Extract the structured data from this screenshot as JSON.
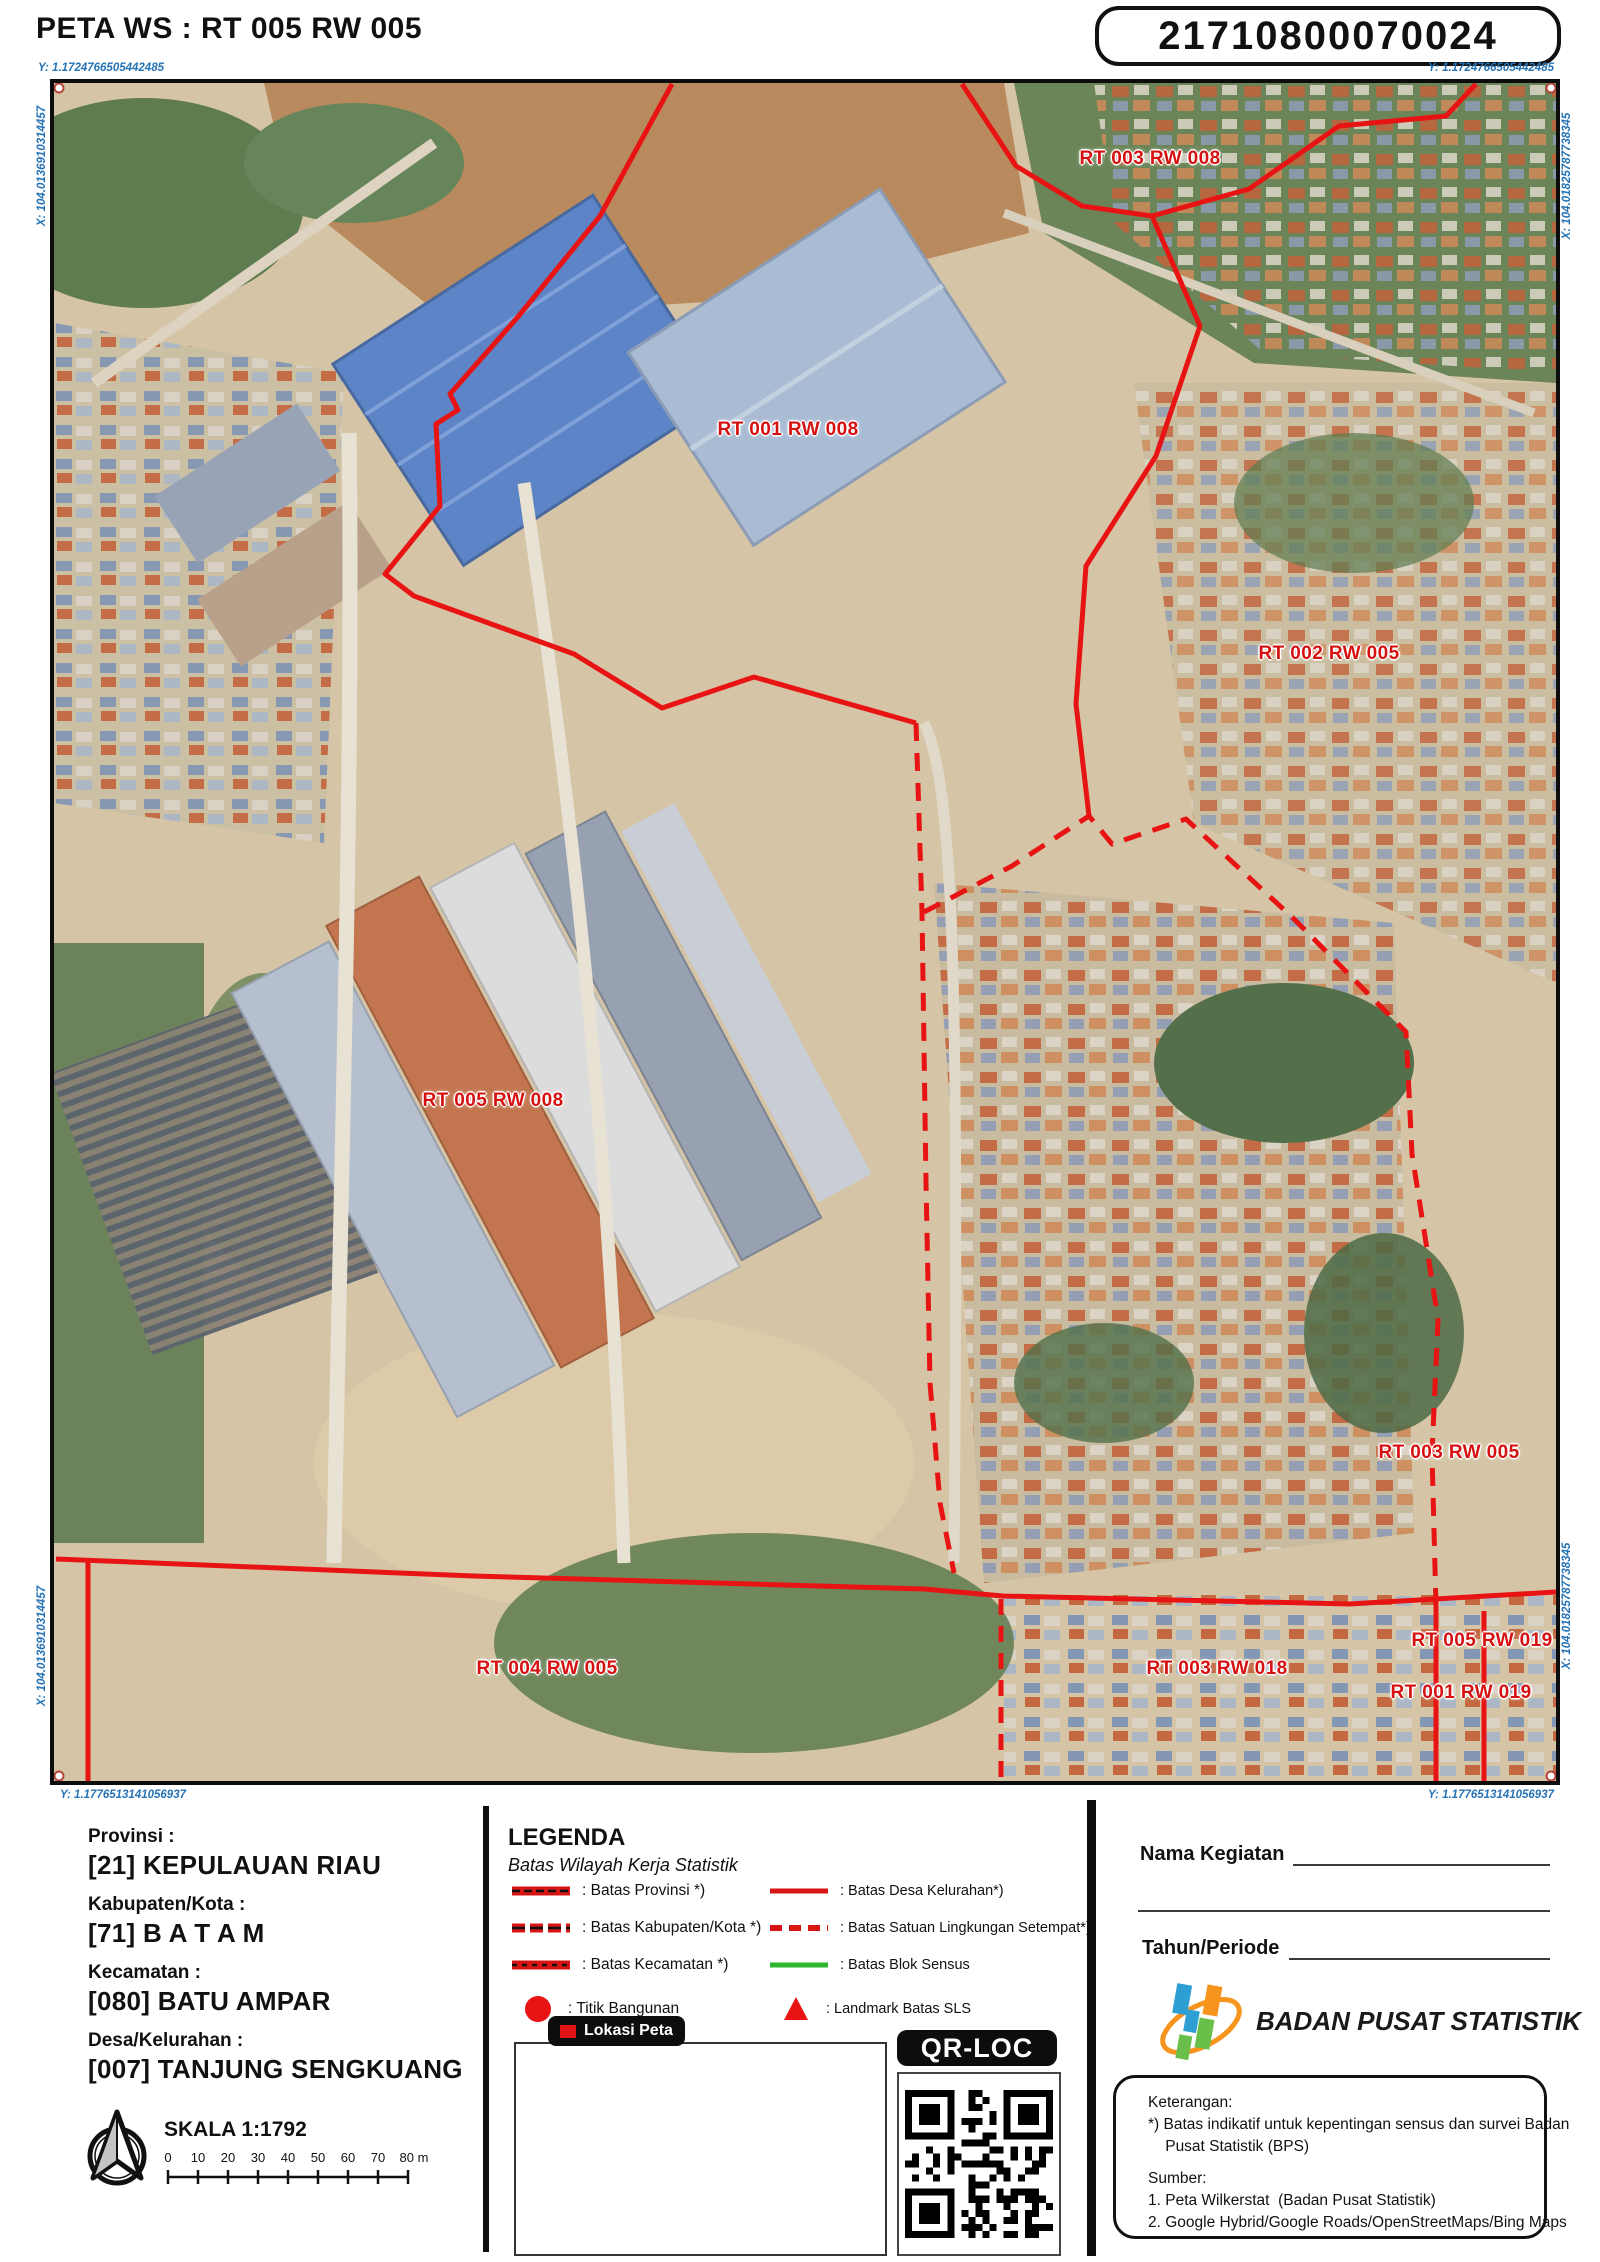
{
  "header": {
    "title": "PETA WS :  RT 005 RW 005",
    "id_box": "21710800070024"
  },
  "map": {
    "coords": {
      "top_left_y": "Y: 1.1724766505442485",
      "top_right_y": "Y: 1.1724766505442485",
      "bottom_left_y": "Y: 1.1776513141056937",
      "bottom_right_y": "Y: 1.1776513141056937",
      "left_x": "X: 104.0136910314457",
      "right_x": "X: 104.01825787738345"
    },
    "labels": [
      {
        "text": "RT 003 RW 008"
      },
      {
        "text": "RT 001 RW 008"
      },
      {
        "text": "RT 002 RW 005"
      },
      {
        "text": "RT 005 RW 008"
      },
      {
        "text": "RT 003 RW 005"
      },
      {
        "text": "RT 004 RW 005"
      },
      {
        "text": "RT 003 RW 018"
      },
      {
        "text": "RT 005 RW 019"
      },
      {
        "text": "RT 001 RW 019"
      }
    ],
    "boundary_color": "#e81414",
    "label_color": "#d61111"
  },
  "info": {
    "rows": [
      {
        "label": "Provinsi :",
        "value": "[21] KEPULAUAN RIAU"
      },
      {
        "label": "Kabupaten/Kota :",
        "value": "[71] B A T A M"
      },
      {
        "label": "Kecamatan :",
        "value": "[080] BATU AMPAR"
      },
      {
        "label": "Desa/Kelurahan :",
        "value": "[007] TANJUNG SENGKUANG"
      }
    ],
    "scale_label": "SKALA 1:1792",
    "scale_ticks": [
      "0",
      "10",
      "20",
      "30",
      "40",
      "50",
      "60",
      "70",
      "80 m"
    ]
  },
  "legend": {
    "title": "LEGENDA",
    "subtitle": "Batas Wilayah Kerja Statistik",
    "items_left": [
      {
        "label": ": Batas Provinsi *)"
      },
      {
        "label": ": Batas Kabupaten/Kota *)"
      },
      {
        "label": ": Batas Kecamatan *)"
      },
      {
        "label": ": Titik Bangunan"
      }
    ],
    "items_right": [
      {
        "label": ": Batas Desa Kelurahan*)"
      },
      {
        "label": ": Batas Satuan Lingkungan Setempat*)"
      },
      {
        "label": ": Batas Blok Sensus"
      },
      {
        "label": ": Landmark Batas SLS"
      }
    ],
    "lokasi_peta": "Lokasi Peta",
    "qr_title": "QR-LOC"
  },
  "form": {
    "nama_kegiatan": "Nama Kegiatan",
    "tahun_periode": "Tahun/Periode"
  },
  "bps": {
    "name": "BADAN PUSAT STATISTIK"
  },
  "keterangan": {
    "title": "Keterangan:",
    "note1": "*) Batas indikatif untuk kepentingan sensus dan survei Badan",
    "note2": "    Pusat Statistik (BPS)",
    "sumber_title": "Sumber:",
    "sumber1": "1. Peta Wilkerstat  (Badan Pusat Statistik)",
    "sumber2": "2. Google Hybrid/Google Roads/OpenStreetMaps/Bing Maps"
  }
}
